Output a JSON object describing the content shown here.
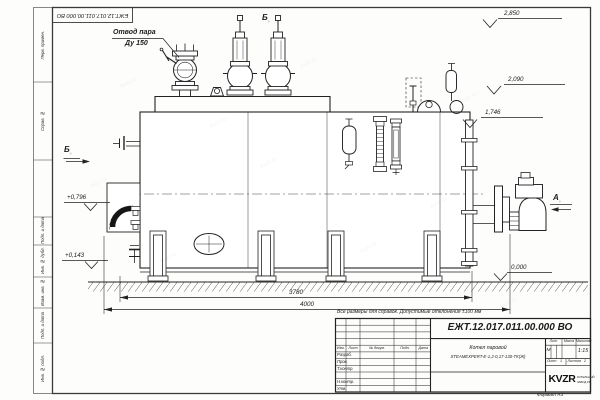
{
  "sheet": {
    "doc_number": "ЕЖТ.12.017.011.00.000  ВО",
    "format_label": "Формат А3",
    "margin_labels": [
      "Перв. примен.",
      "Справ. №",
      "Подп. и дата",
      "Инв. № дубл.",
      "Взам. инв. №",
      "Подп. и дата",
      "Инв. № подл."
    ],
    "watermark": "kvzr.ru"
  },
  "drawing": {
    "callout_line1": "Отвод пара",
    "callout_line2": "Ду 150",
    "view_b": "Б",
    "view_a": "А",
    "view_mark": "○",
    "elevations": {
      "top": "2,850",
      "mid": "2,090",
      "low": "1,746",
      "left_upper": "+0,796",
      "left_lower": "+0,143",
      "ground": "0,000"
    },
    "dim_inner": "3780",
    "dim_overall": "4000",
    "note": "Все размеры для справок. Допустимые отклонения ±100 мм"
  },
  "title_block": {
    "doc_number": "ЕЖТ.12.017.011.00.000  ВО",
    "col_izm": "Изм.",
    "col_list": "Лист",
    "col_doc": "№ докум.",
    "col_podp": "Подп.",
    "col_data": "Дата",
    "row_razrab": "Разраб.",
    "row_prov": "Пров.",
    "row_tkontr": "Т.контр.",
    "row_nkontr": "Н.контр.",
    "row_utv": "Утв.",
    "product_line1": "Котел паровой",
    "product_line2": "STEAMEXPERT-Е-1,2-0,17-130-ТК(Ж)",
    "lit_label": "Лит.",
    "lit_value": "М",
    "mass_label": "Масса",
    "scale_label": "Масштаб",
    "scale_value": "1:15",
    "sheet_label": "Лист",
    "sheet_value": "1",
    "sheets_label": "Листов",
    "sheets_value": "2",
    "company_logo": "KVZR",
    "company_line1": "КОТЕЛЬНЫЙ",
    "company_line2": "ЗАВОД РФ"
  }
}
